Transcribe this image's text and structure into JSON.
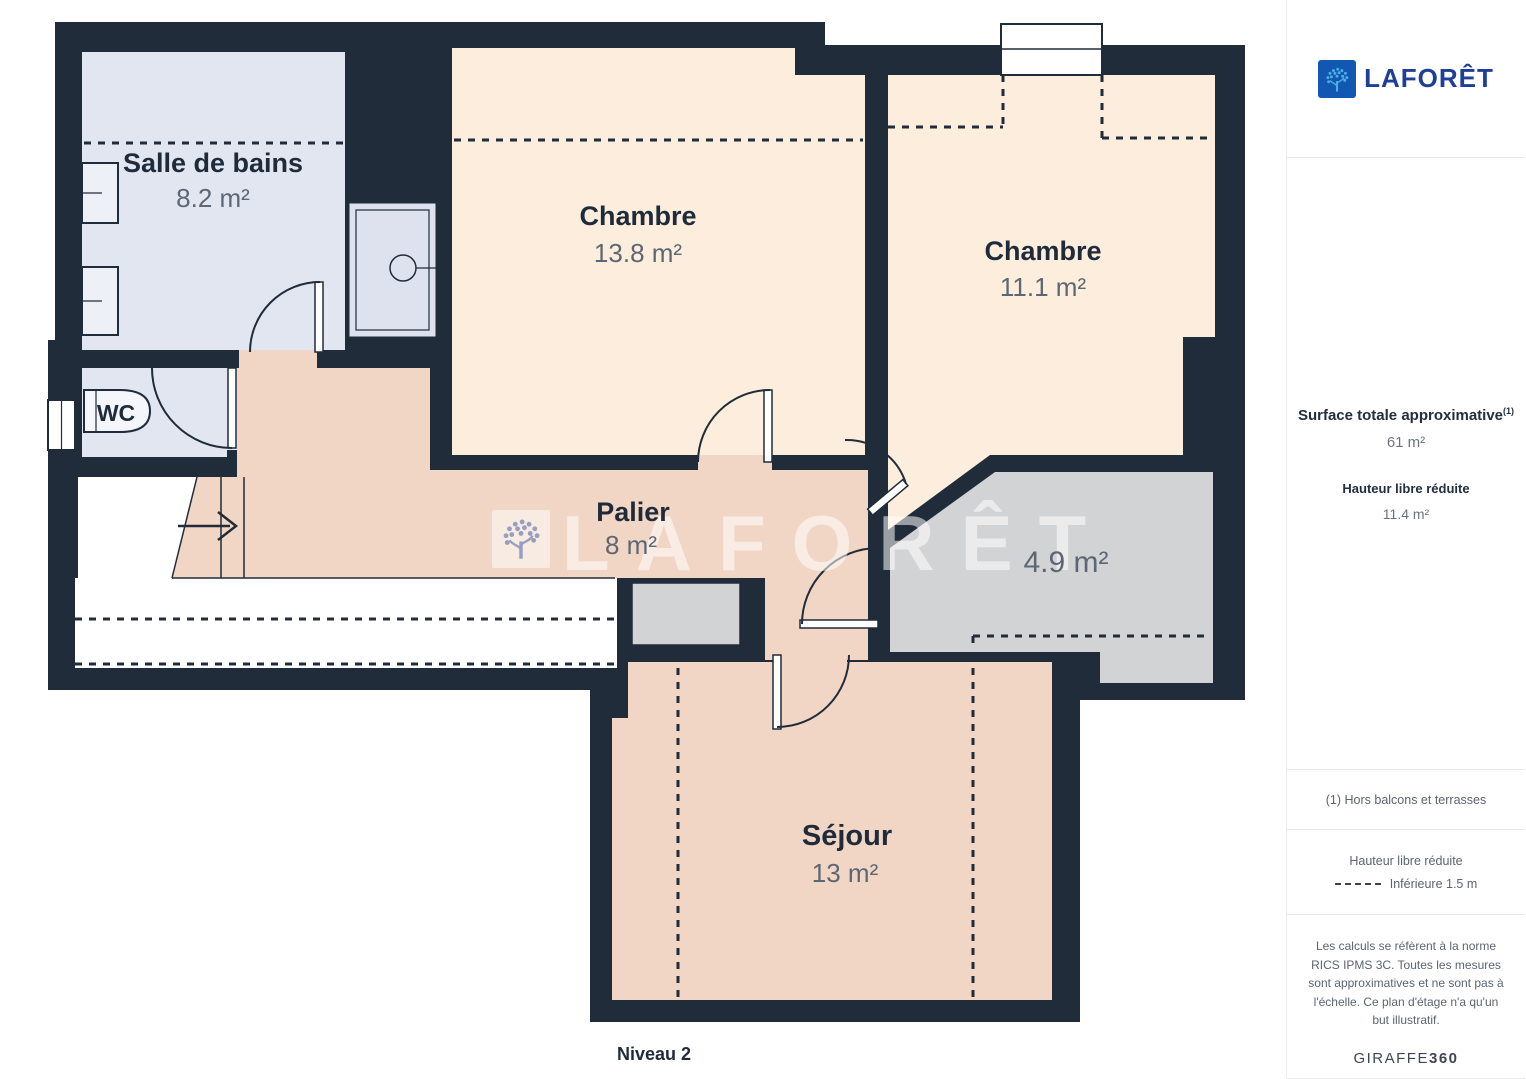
{
  "plan": {
    "level_label": "Niveau 2",
    "watermark_text": "LAFORÊT",
    "rooms": {
      "salle_de_bains": {
        "name": "Salle de bains",
        "area": "8.2 m²"
      },
      "chambre_1": {
        "name": "Chambre",
        "area": "13.8 m²"
      },
      "chambre_2": {
        "name": "Chambre",
        "area": "11.1 m²"
      },
      "wc": {
        "name": "WC"
      },
      "palier": {
        "name": "Palier",
        "area": "8 m²"
      },
      "reduced_height_area": {
        "area": "4.9 m²"
      },
      "sejour": {
        "name": "Séjour",
        "area": "13 m²"
      }
    },
    "colors": {
      "wall": "#202c3a",
      "bedroom_floor": "#fdeddc",
      "hall_floor": "#f1d6c5",
      "bathroom_floor": "#e2e6f1",
      "reduced_floor": "#d2d3d5"
    }
  },
  "sidebar": {
    "brand": "LAFORÊT",
    "surface_title": "Surface totale approximative",
    "surface_superscript": "(1)",
    "surface_value": "61 m²",
    "reduced_height_title": "Hauteur libre réduite",
    "reduced_height_value": "11.4 m²",
    "footnote": "(1) Hors balcons et terrasses",
    "legend_title": "Hauteur libre réduite",
    "legend_value": "Inférieure 1.5 m",
    "disclaimer": "Les calculs se réfèrent à la norme RICS IPMS 3C. Toutes les mesures sont approximatives et ne sont pas à l'échelle. Ce plan d'étage n'a qu'un but illustratif.",
    "credit_brand": "GIRAFFE",
    "credit_number": "360"
  }
}
